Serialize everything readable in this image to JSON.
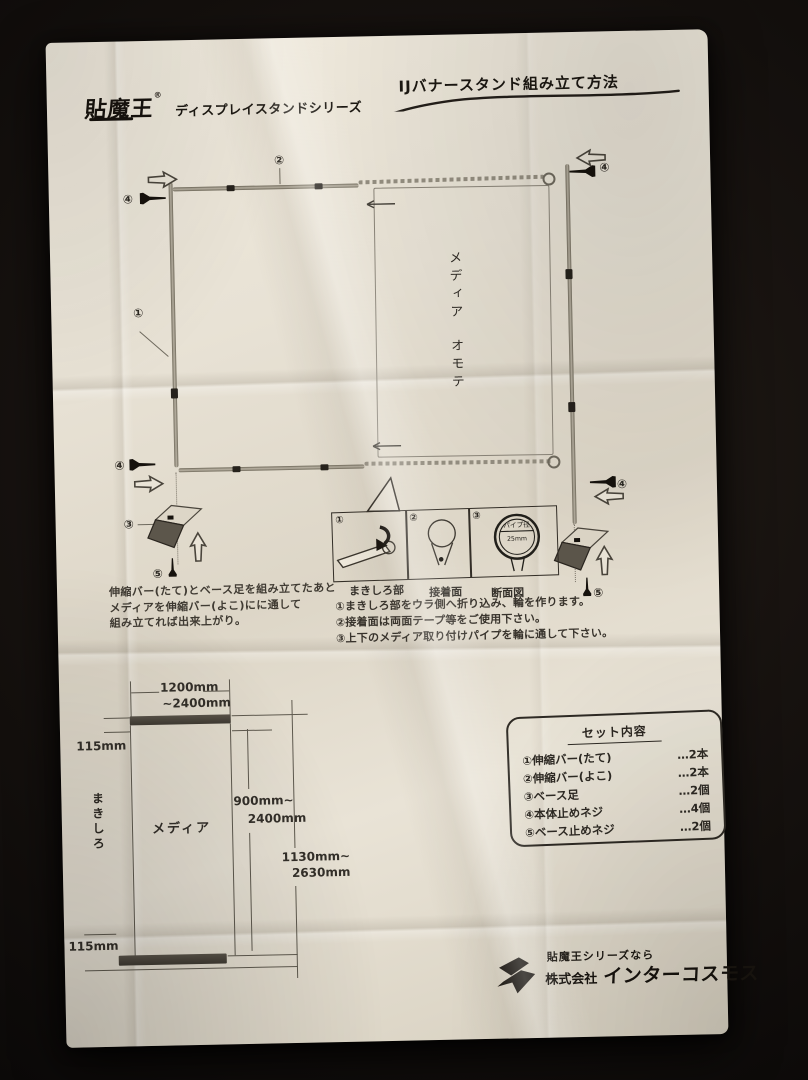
{
  "header": {
    "logo": "貼魔王",
    "logo_reg": "®",
    "series": "ディスプレイスタンドシリーズ",
    "title": "IJバナースタンド組み立て方法"
  },
  "diagram": {
    "nums": {
      "n1": "①",
      "n2": "②",
      "n3": "③",
      "n4": "④",
      "n5": "⑤"
    },
    "media_front_1": "メディア",
    "media_front_2": "オモテ"
  },
  "assembly_note": {
    "line1": "伸縮バー(たて)とベース足を組み立てたあと",
    "line2": "メディアを伸縮バー(よこ)にに通して",
    "line3": "組み立てれば出来上がり。"
  },
  "panel_box": {
    "label1": "まきしろ部",
    "label2": "接着面",
    "label3": "断面図",
    "pipe_line1": "パイプ径",
    "pipe_line2": "25mm"
  },
  "steps": {
    "s1": "①まきしろ部をウラ側へ折り込み、輪を作ります。",
    "s2": "②接着面は両面テープ等をご使用下さい。",
    "s3": "③上下のメディア取り付けパイプを輪に通して下さい。"
  },
  "dimensions": {
    "width_1": "1200mm",
    "width_2": "~2400mm",
    "margin_top": "115mm",
    "makishiro": "まきしろ",
    "media": "メディア",
    "height_1": "900mm~",
    "height_2": "2400mm",
    "total_1": "1130mm~",
    "total_2": "2630mm",
    "margin_bottom": "115mm"
  },
  "set_contents": {
    "title": "セット内容",
    "items": [
      {
        "label": "①伸縮バー(たて)",
        "count": "…2本"
      },
      {
        "label": "②伸縮バー(よこ)",
        "count": "…2本"
      },
      {
        "label": "③ベース足",
        "count": "…2個"
      },
      {
        "label": "④本体止めネジ",
        "count": "…4個"
      },
      {
        "label": "⑤ベース止めネジ",
        "count": "…2個"
      }
    ]
  },
  "footer": {
    "tagline": "貼魔王シリーズなら",
    "company_prefix": "株式会社",
    "company_name": "インターコスモス"
  },
  "colors": {
    "paper": "#e8e2d5",
    "background": "#181310",
    "ink": "#2e2a24"
  }
}
